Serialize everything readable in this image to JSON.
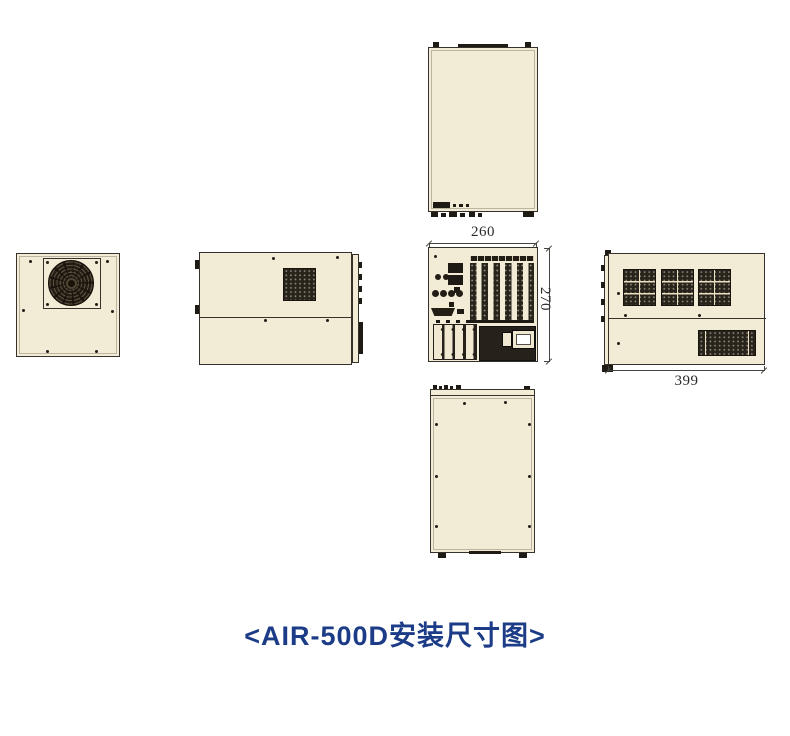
{
  "caption": {
    "text": "<AIR-500D安装尺寸图>"
  },
  "dimensions": {
    "top_width": "260",
    "right_height": "270",
    "side_length": "399"
  },
  "colors": {
    "panel_fill": "#f2ebd6",
    "outline_dark": "#36322b",
    "vent_dark": "#28231b",
    "caption_blue": "#1d3c87",
    "background": "#ffffff"
  }
}
